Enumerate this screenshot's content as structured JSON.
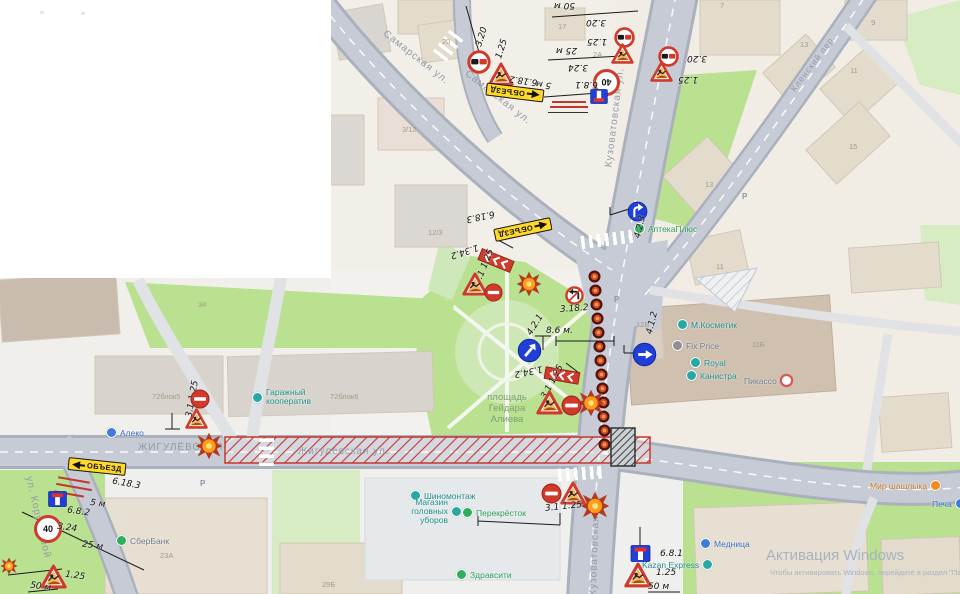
{
  "streets": {
    "samarskaya": "Самарская ул.",
    "kuzovatovskaya": "Кузоватовская ул.",
    "zhigulevskaya_caps": "ЖИГУЛЁВСКАЯ",
    "zhigulevskaya": "Жигулевская ул.",
    "korunkovoy": "ул. Корунковой",
    "klensky": "Кленский пер."
  },
  "square": {
    "l1": "площадь",
    "l2": "Гейдара",
    "l3": "Алиева"
  },
  "pois": {
    "aleko": "Алеко",
    "garazh": "Гаражный кооператив",
    "apteka": "АптекаПлюс",
    "mkosmetik": "М.Косметик",
    "fixprice": "Fix Price",
    "royal": "Royal",
    "kanistra": "Канистра",
    "picasso": "Пикассо",
    "shinomontazh": "Шиномонтаж",
    "magazin": "Магазин головных уборов",
    "perekrestok": "Перекрёсток",
    "zdravsiti": "Здравсити",
    "sberbank": "СберБанк",
    "kazanexpress": "Kazan Express",
    "mednitsa": "Медница",
    "mirshashlyka": "Мир шашлыка",
    "pechat": "Печа"
  },
  "buildings": {
    "b17": "17",
    "b20": "20",
    "b312": "3/12",
    "b123": "12/3",
    "b7": "7",
    "b9": "9",
    "b13a": "13",
    "b11a": "11",
    "b2a": "2А",
    "b15": "15",
    "b13b": "13",
    "b11c": "11",
    "b12b": "12Б",
    "b11bd": "11Б",
    "b72_5": "72блок5",
    "b72_6": "72блок6",
    "b23a": "23А",
    "b34": "34",
    "b29b": "29Б"
  },
  "codes": {
    "c320": "3.20",
    "c125": "1.25",
    "c324": "3.24",
    "c40": "40",
    "c681": "6.8.1",
    "c682": "6.8.2",
    "c6182": "6.18.2",
    "c6183": "6.18.3",
    "c31125": "3.1 1.25",
    "c1342": "1.34.2",
    "c3182": "3.18.2",
    "c421": "4.2.1",
    "c412": "4.1.2",
    "c423": "4.2.3"
  },
  "dist": {
    "d50": "50 м",
    "d25": "25 м",
    "d5": "5 м",
    "d86": "8.6 м."
  },
  "detour_label": "ОБЪЕЗД",
  "parking": "Р",
  "watermark": {
    "l1": "Активация Windows",
    "l2": "Чтобы активировать Windows, перейдите в раздел \"Параметры\"."
  }
}
